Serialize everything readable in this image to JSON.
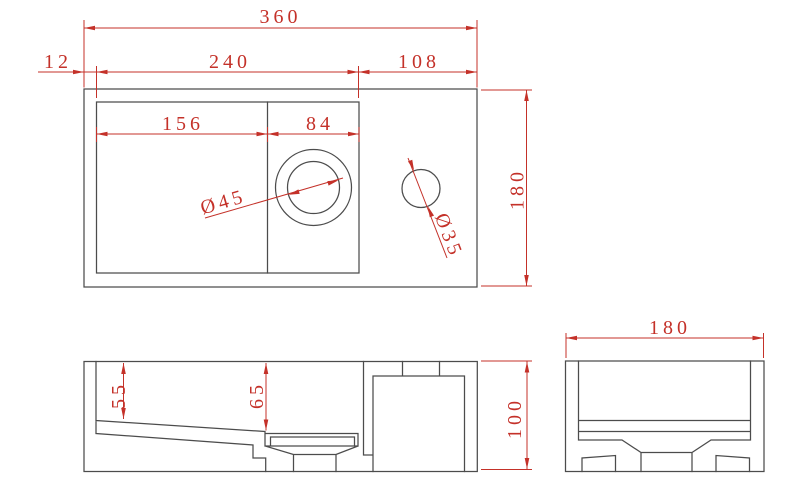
{
  "colors": {
    "geometry": "#4c4c4c",
    "dimension": "#c43129",
    "background": "#ffffff"
  },
  "labels": {
    "top_view": {
      "overall_width": "360",
      "rim_offset": "12",
      "basin_width": "240",
      "deck_width": "108",
      "slope_section_width": "156",
      "drain_section_width": "84",
      "overall_depth": "180",
      "drain_diameter": "Ø45",
      "faucet_hole_diameter": "Ø35"
    },
    "front_view": {
      "basin_depth_left": "55",
      "basin_depth_at_drain": "65",
      "overall_height": "100"
    },
    "side_view": {
      "overall_depth": "180"
    }
  }
}
